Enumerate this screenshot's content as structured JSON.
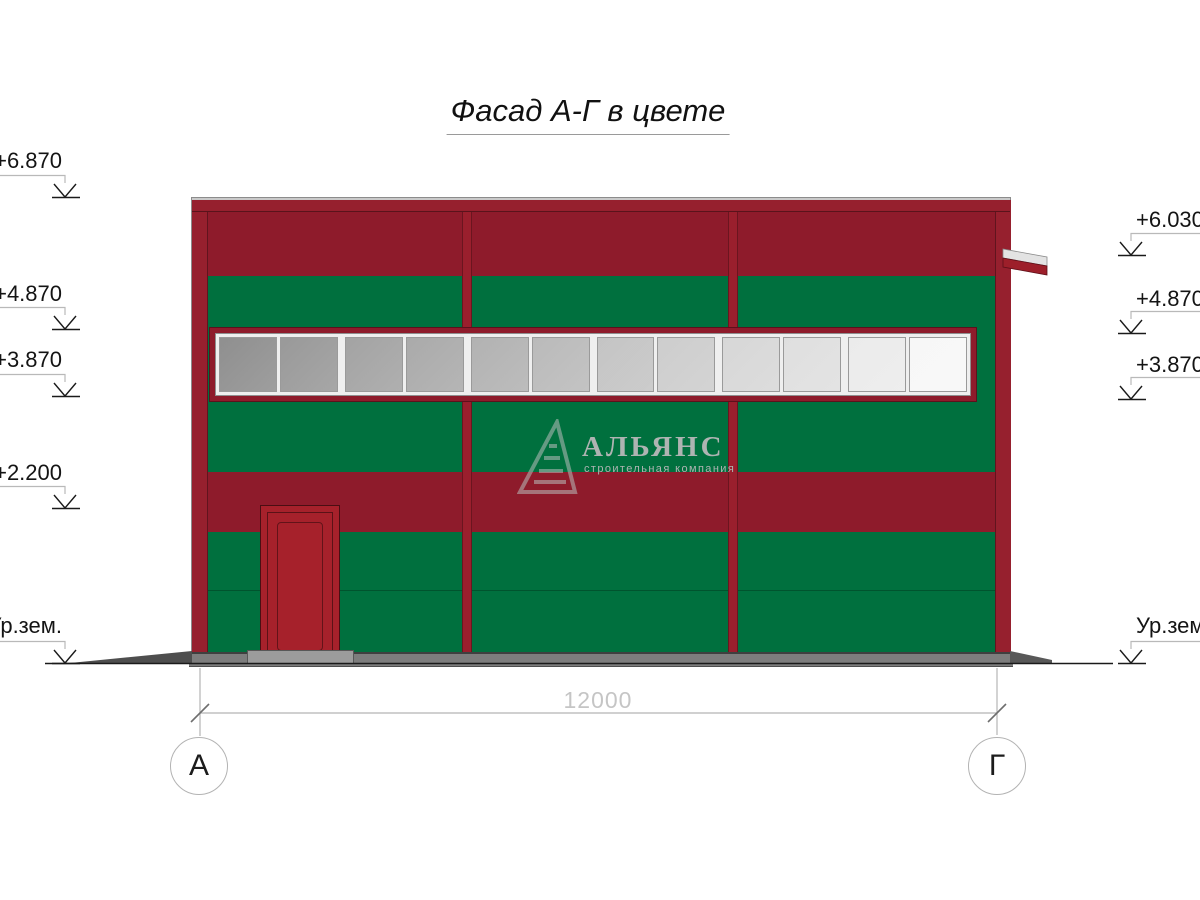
{
  "title": "Фасад А-Г в цвете",
  "logo": {
    "name": "АЛЬЯНС",
    "tagline": "строительная компания",
    "icon": "pyramid-icon"
  },
  "dimension": {
    "value": "12000"
  },
  "axes": {
    "left": "А",
    "right": "Г"
  },
  "elevations_left": [
    {
      "label": "+6.870"
    },
    {
      "label": "+4.870"
    },
    {
      "label": "+3.870"
    },
    {
      "label": "+2.200"
    },
    {
      "label": "Ур.зем."
    }
  ],
  "elevations_right": [
    {
      "label": "+6.030"
    },
    {
      "label": "+4.870"
    },
    {
      "label": "+3.870"
    },
    {
      "label": "Ур.зем."
    }
  ],
  "window": {
    "pane_count": 12,
    "pane_shades": [
      "#8f8f8f",
      "#999999",
      "#a3a3a3",
      "#aaaaaa",
      "#b2b2b2",
      "#bababa",
      "#c4c4c4",
      "#cdcdcd",
      "#d7d7d7",
      "#dfdfdf",
      "#ebebeb",
      "#f7f7f7"
    ]
  },
  "colors": {
    "band_red": "#8e1b2b",
    "cap_red": "#96202e",
    "pilaster_red": "#96202e",
    "divider_red": "#9a1f2d",
    "door_red": "#a6212b",
    "green": "#00703e",
    "base_gray": "#7d7d7d",
    "wedge_gray": "#4e4e4e",
    "threshold_gray": "#9c9c9c",
    "canopy_white": "#e3e3e3",
    "canopy_red": "#9d1f2a",
    "line_gray": "#b5b5b5",
    "dim_gray": "#c5c5c5",
    "watermark": "#aeb4b2"
  }
}
